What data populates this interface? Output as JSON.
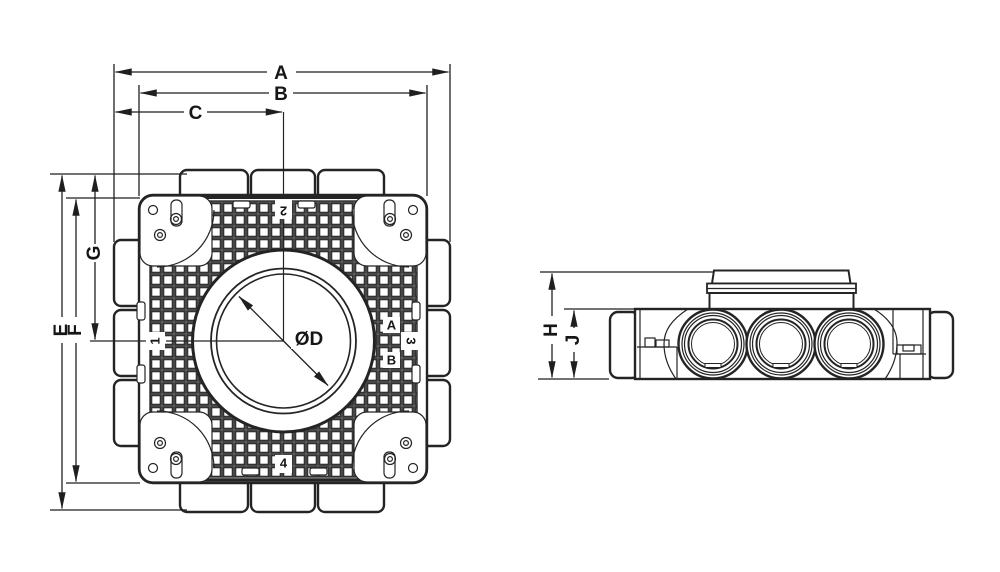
{
  "front_view": {
    "dim_width_overall": "A",
    "dim_width_body": "B",
    "dim_width_to_center": "C",
    "dim_height_overall": "E",
    "dim_height_body": "F",
    "dim_height_to_center": "G",
    "spigot_diameter": "ØD",
    "port_left": "1",
    "port_top": "2",
    "port_right": "3",
    "port_bottom": "4",
    "outlet_row_a": "A",
    "outlet_row_b": "B"
  },
  "side_view": {
    "dim_height_with_collar": "H",
    "dim_height_body": "J"
  },
  "colors": {
    "line": "#242424",
    "background": "#ffffff"
  }
}
